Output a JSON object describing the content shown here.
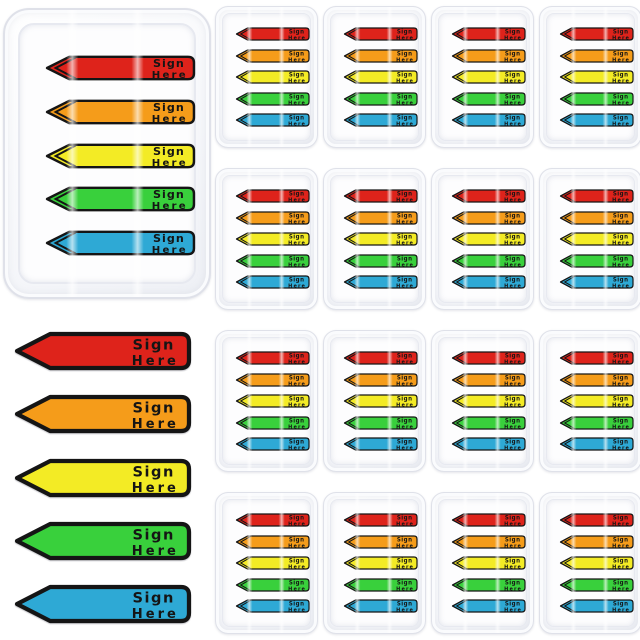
{
  "product": {
    "flag_label": {
      "line1": "Sign",
      "line2": "Here"
    },
    "flag_colors": [
      {
        "name": "red",
        "hex": "#de231b"
      },
      {
        "name": "orange",
        "hex": "#f59c1a"
      },
      {
        "name": "yellow",
        "hex": "#f3eb25"
      },
      {
        "name": "green",
        "hex": "#39d03c"
      },
      {
        "name": "blue",
        "hex": "#2ea9d5"
      }
    ],
    "outline_color": "#151515",
    "large_dispensers": {
      "count": 1,
      "flags_per_dispenser": 5
    },
    "small_dispensers": {
      "count": 16,
      "rows": 4,
      "cols": 4,
      "flags_per_dispenser": 5
    },
    "loose_flags": {
      "count": 5
    }
  }
}
